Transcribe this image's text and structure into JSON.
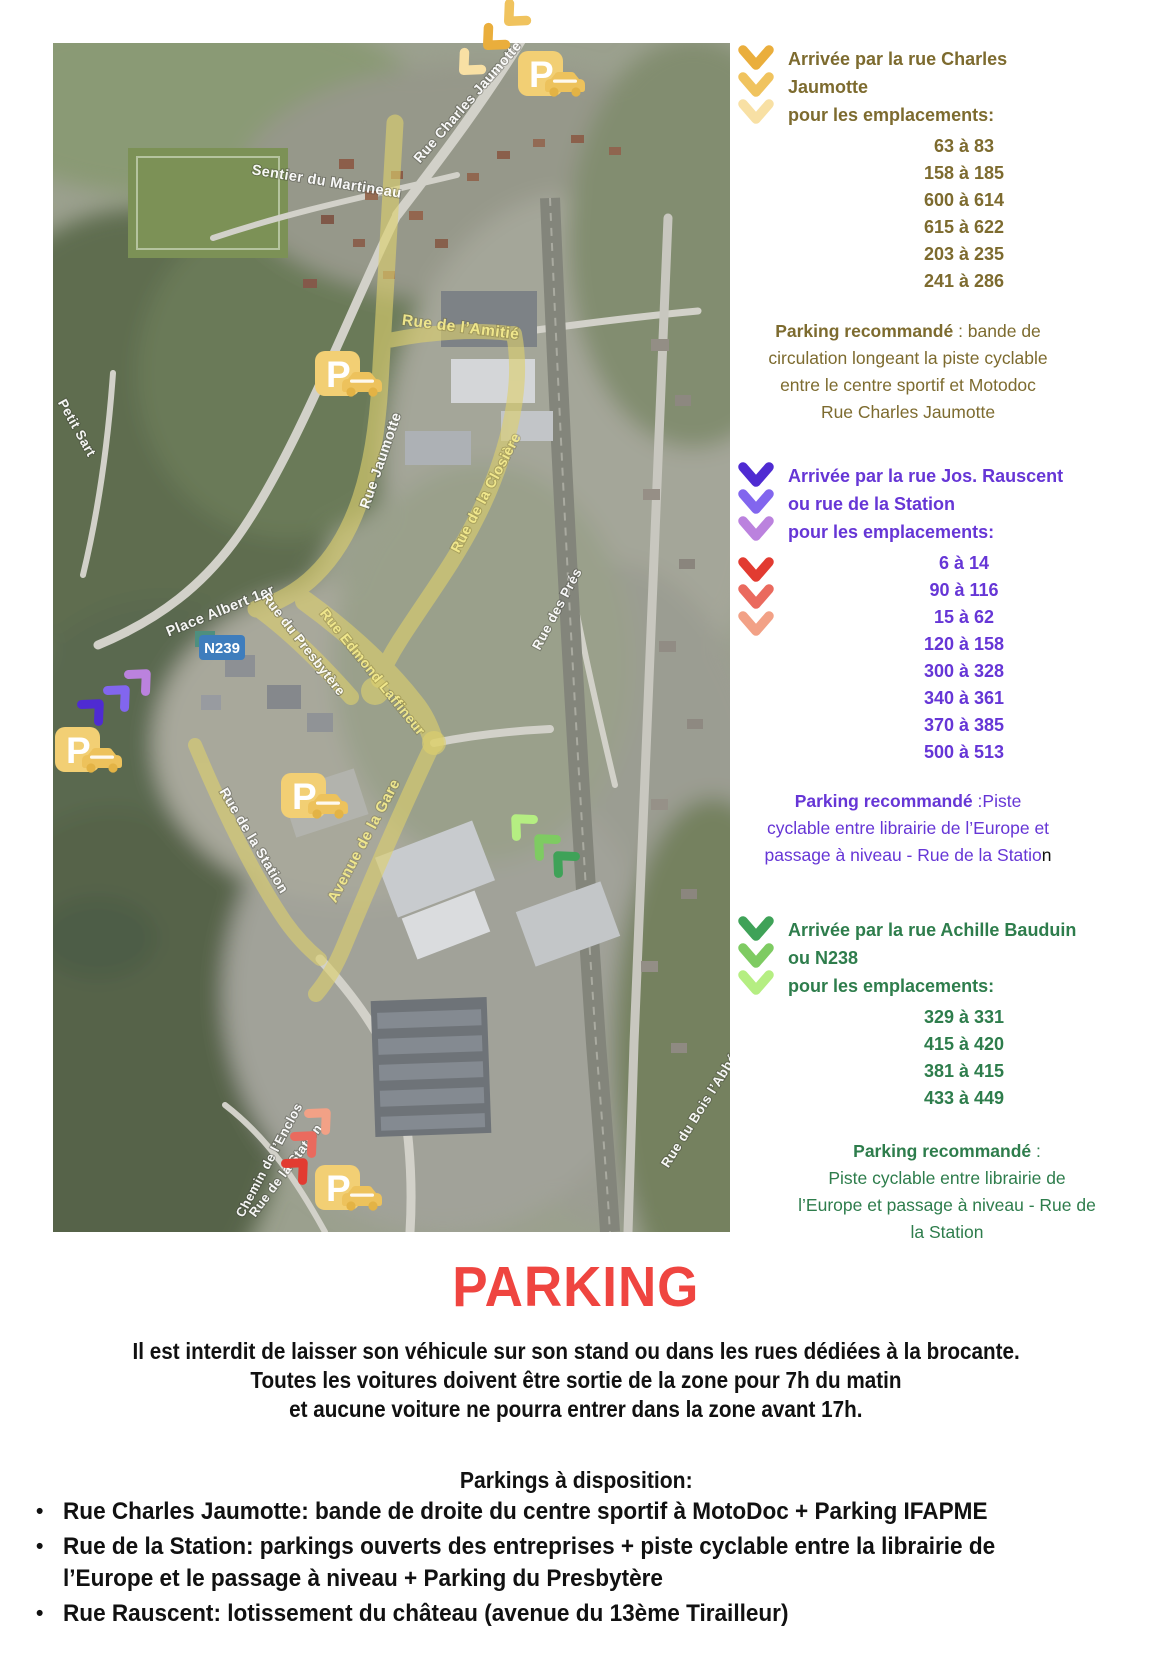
{
  "palette": {
    "olive": "#7d6b2f",
    "purple": "#6636d6",
    "green": "#2e7d4c",
    "title_red": "#ef4540",
    "text_black": "#111111",
    "route_yellow": "#ddd06e",
    "sign_blue": "#3e7dbd",
    "parking_gold": "#f2cf74"
  },
  "chevrons": {
    "yellow": [
      "#eaae3c",
      "#f0c35e",
      "#f8e0a4"
    ],
    "purple": [
      "#4f2bd2",
      "#8266ee",
      "#bb82de"
    ],
    "red": [
      "#e23b31",
      "#ea6a5e",
      "#f2a186"
    ],
    "green": [
      "#3fa258",
      "#7ecb62",
      "#b5ee82"
    ]
  },
  "map": {
    "road_sign": "N239",
    "parking_letter": "P",
    "labels": [
      "Rue Charles Jaumotte",
      "Sentier du Martineau",
      "Rue de l’Amitié",
      "Rue Jaumotte",
      "Rue de la Closière",
      "Petit Sart",
      "Place Albert 1er",
      "Rue du Presbytère",
      "Rue Edmond Laffineur",
      "Rue des Prés",
      "Rue de la Station",
      "Avenue de la Gare",
      "Rue du Bois l’Abbé",
      "Chemin de l’Enclos",
      "Rue de la Station"
    ]
  },
  "blocks": [
    {
      "header_lines": [
        "Arrivée par la rue Charles",
        "Jaumotte",
        "pour les emplacements:"
      ],
      "ranges": [
        "63 à 83",
        "158 à 185",
        "600 à 614",
        "615 à 622",
        "203 à 235",
        "241 à 286"
      ],
      "parking": {
        "bold": "Parking recommandé",
        "line1_rest": " : bande de",
        "lines": [
          "circulation longeant la piste cyclable",
          "entre le centre sportif et Motodoc",
          "Rue Charles Jaumotte"
        ]
      }
    },
    {
      "header_lines": [
        "Arrivée par la rue Jos. Rauscent",
        "ou rue de la Station",
        "pour les emplacements:"
      ],
      "ranges": [
        "6 à 14",
        "90 à 116",
        "15 à 62",
        "120 à 158",
        "300 à 328",
        "340 à 361",
        "370 à 385",
        "500 à 513"
      ],
      "parking": {
        "bold": "Parking recommandé",
        "line1_rest": " :Piste",
        "lines": [
          "cyclable entre librairie de l’Europe et",
          "passage à niveau - Rue de la Statio"
        ],
        "suffix": "n"
      }
    },
    {
      "header_lines": [
        "Arrivée par la rue Achille Bauduin",
        "ou N238",
        "pour les emplacements:"
      ],
      "ranges": [
        "329 à 331",
        "415 à 420",
        "381 à 415",
        "433 à 449"
      ],
      "parking": {
        "bold": "Parking recommandé",
        "line1_rest": " :",
        "lines": [
          "Piste cyclable entre librairie de",
          "l’Europe et passage à niveau - Rue de",
          "la Station"
        ]
      }
    }
  ],
  "bottom": {
    "title": "PARKING",
    "intro_lines": [
      "Il est interdit de laisser son véhicule sur son stand ou dans les rues dédiées à la brocante.",
      "Toutes les voitures doivent être sortie de la zone pour 7h du matin",
      "et aucune voiture ne pourra entrer dans la zone avant 17h."
    ],
    "subtitle": "Parkings à disposition:",
    "bullets": [
      {
        "lines": [
          "Rue Charles Jaumotte: bande de droite du centre sportif à MotoDoc + Parking IFAPME"
        ]
      },
      {
        "lines": [
          "Rue de la Station: parkings ouverts des entreprises + piste cyclable entre la librairie de",
          "l’Europe et le passage à niveau + Parking du Presbytère"
        ]
      },
      {
        "lines": [
          "Rue Rauscent: lotissement du château (avenue du 13ème Tirailleur)"
        ]
      }
    ]
  }
}
